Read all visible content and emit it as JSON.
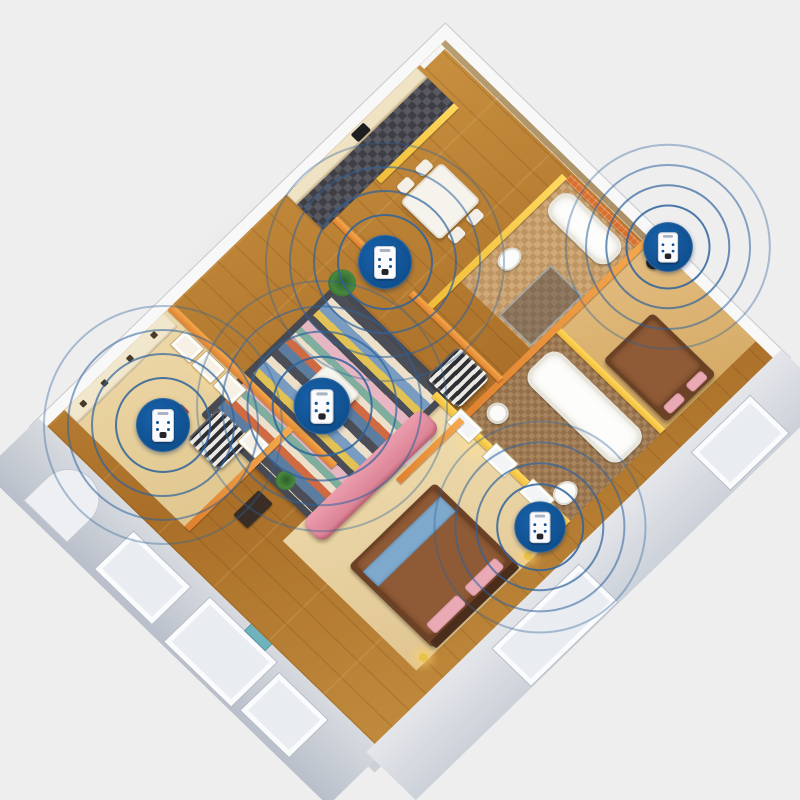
{
  "scene": {
    "type": "3d-isometric-apartment-cutaway-floor-plan",
    "subject": "five plug-in ultrasonic pest repeller devices emitting circular signal waves, one per room",
    "background_color": "#efeeef",
    "device_count": 5
  },
  "palette": {
    "background": "#efeeef",
    "outer_wall_top": "#f8f8f9",
    "exterior_wall_face": "#c0c6cf",
    "inner_wall_orange": "#e0812f",
    "inner_wall_yellow": "#f0bd3a",
    "bath_tile_orange": "#d9712e",
    "oak_floor": "#b97b33",
    "birch_floor": "#ead7a9",
    "kitchen_tile_dark": "#46464c",
    "rug_charcoal": "#4b4e57",
    "sofa_pink": "#e18da0",
    "bed_brown": "#6b4226",
    "bed_runner_blue": "#7ea9cd",
    "device_badge_blue": "#0f4f8e",
    "signal_ring_blue": "#2e639c",
    "device_body_white": "#fbfbfd"
  },
  "rooms": [
    {
      "id": "kitchen",
      "floor": "dark-checker-tile",
      "features": [
        "cream-cabinets",
        "stove"
      ]
    },
    {
      "id": "dining-area",
      "floor": "oak-wood",
      "features": [
        "white-dining-table",
        "four-chairs"
      ]
    },
    {
      "id": "bathroom-top",
      "walls": "orange-tile",
      "features": [
        "bathtub",
        "toilet",
        "glass-shower"
      ]
    },
    {
      "id": "bedroom-top-right",
      "walls": "yellow",
      "features": [
        "bed",
        "black-floor-lamp"
      ]
    },
    {
      "id": "bathroom-right",
      "floor": "brown-mosaic",
      "walls": "orange-tile",
      "features": [
        "bathtub",
        "sink",
        "toilet"
      ]
    },
    {
      "id": "master-bedroom",
      "floor": "birch-wood",
      "walls": "yellow-with-windows",
      "features": [
        "double-bed-blue-runner",
        "pink-pillows",
        "gold-bedside-lamps",
        "white-screen"
      ]
    },
    {
      "id": "living-room",
      "floor": "oak-wood",
      "features": [
        "striped-multicolor-rug",
        "white-coffee-table",
        "pink-sofa",
        "two-zebra-armchairs",
        "potted-plant"
      ]
    },
    {
      "id": "hallway",
      "features": [
        "console-table",
        "plant"
      ]
    },
    {
      "id": "study",
      "walls": "orange-with-picture-frames",
      "features": [
        "white-shelving-unit",
        "red-stool"
      ]
    }
  ],
  "devices": [
    {
      "id": "dining",
      "room": "dining-area",
      "x": 385,
      "y": 262,
      "scale": 1.0,
      "rings": [
        46,
        70,
        94,
        118
      ]
    },
    {
      "id": "living",
      "room": "living-room",
      "x": 322,
      "y": 406,
      "scale": 1.05,
      "rings": [
        46,
        70,
        94,
        118
      ]
    },
    {
      "id": "bedroom-right",
      "room": "bedroom-top-right",
      "x": 668,
      "y": 247,
      "scale": 0.92,
      "rings": [
        44,
        66,
        88,
        110
      ]
    },
    {
      "id": "master",
      "room": "master-bedroom",
      "x": 540,
      "y": 527,
      "scale": 0.95,
      "rings": [
        44,
        66,
        88,
        110
      ]
    },
    {
      "id": "study",
      "room": "study",
      "x": 163,
      "y": 425,
      "scale": 1.0,
      "rings": [
        46,
        70,
        94,
        118
      ]
    }
  ],
  "ring_opacities": [
    0.85,
    0.7,
    0.55,
    0.38
  ]
}
